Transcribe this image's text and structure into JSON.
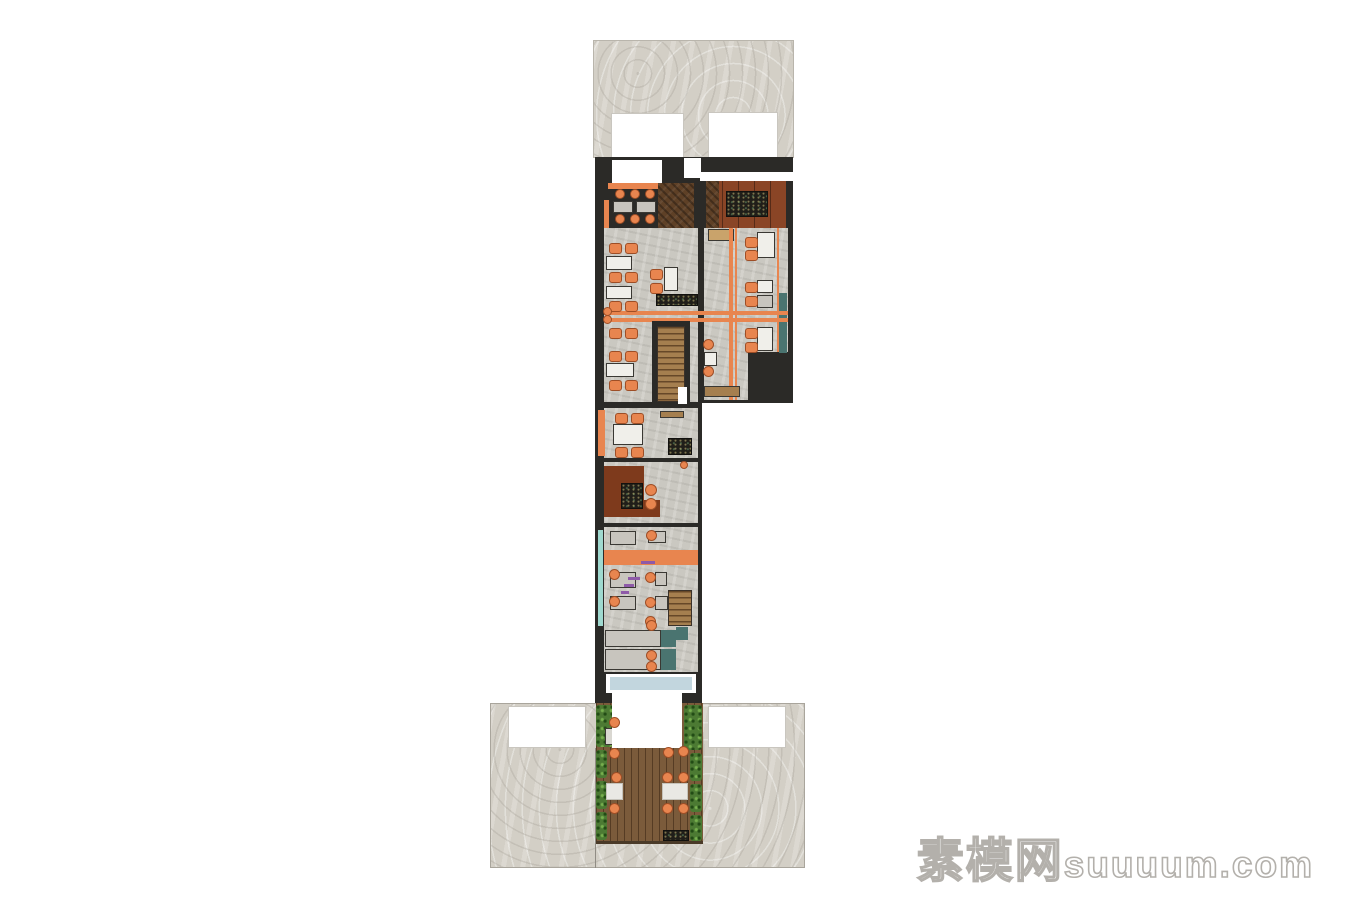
{
  "watermark": {
    "brand": "素模网",
    "site": "suuuum.com"
  },
  "palette": {
    "wall": "#2B2A27",
    "wallsoft": "#3A3833",
    "pave": "#D3CFC6",
    "conc": "#CAC8C1",
    "orange": "#E8854F",
    "orangeDark": "#9E4E26",
    "teal": "#4A7470",
    "tealLight": "#9FD9CF",
    "glass": "#C2D6DE",
    "white": "#FFFFFF",
    "rust": "#7E3A1C",
    "rust2": "#8A4526",
    "wood": "#A57F4F",
    "deckEdge": "#4A3A28",
    "tan": "#C9A36B",
    "grayTable": "#C8C5BE",
    "tableWhite": "#F0EFEA",
    "purple": "#8E5AA8",
    "hedge": "#4C7A33",
    "divider": "#908C84",
    "openingEdge": "#C9C6BF",
    "paveEdge": "#A9A59C"
  },
  "plan": {
    "items": [
      {
        "n": "upper-courtyard-pavement",
        "x": 593,
        "y": 40,
        "w": 201,
        "h": 118,
        "t": "tx-pave",
        "b": "#B9B5AC"
      },
      {
        "n": "upper-opening-left",
        "x": 611,
        "y": 113,
        "w": 73,
        "h": 50,
        "f": "white",
        "b": "openingEdge"
      },
      {
        "n": "upper-opening-right",
        "x": 708,
        "y": 112,
        "w": 70,
        "h": 50,
        "f": "white",
        "b": "openingEdge"
      },
      {
        "n": "wall-main-column",
        "x": 595,
        "y": 157,
        "w": 107,
        "h": 546,
        "f": "wall"
      },
      {
        "n": "wall-right-wing",
        "x": 702,
        "y": 157,
        "w": 91,
        "h": 246,
        "f": "wall"
      },
      {
        "n": "roomA-entry-white",
        "x": 612,
        "y": 160,
        "w": 50,
        "h": 25,
        "f": "white"
      },
      {
        "n": "roomA-wall-notch",
        "x": 684,
        "y": 158,
        "w": 17,
        "h": 20,
        "f": "white"
      },
      {
        "n": "roomA-wood-floor",
        "x": 658,
        "y": 183,
        "w": 36,
        "h": 47,
        "t": "tx-hb"
      },
      {
        "n": "roomA-bench-band",
        "x": 608,
        "y": 183,
        "w": 50,
        "h": 6,
        "f": "orange"
      },
      {
        "n": "roomA-table",
        "x": 613,
        "y": 201,
        "w": 20,
        "h": 12,
        "f": "grayTable",
        "b": "wallsoft"
      },
      {
        "n": "roomA-table",
        "x": 636,
        "y": 201,
        "w": 20,
        "h": 12,
        "f": "grayTable",
        "b": "wallsoft"
      },
      {
        "n": "roomA-side-bench",
        "x": 604,
        "y": 200,
        "w": 5,
        "h": 28,
        "f": "orange"
      },
      {
        "n": "roomB-beam-white",
        "x": 700,
        "y": 172,
        "w": 93,
        "h": 9,
        "f": "white"
      },
      {
        "n": "roomB-floor",
        "x": 706,
        "y": 181,
        "w": 80,
        "h": 50,
        "f": "rust2",
        "t": "tx-panel"
      },
      {
        "n": "roomB-wood-column",
        "x": 706,
        "y": 181,
        "w": 13,
        "h": 50,
        "t": "tx-hb"
      },
      {
        "n": "roomB-stone-table",
        "x": 726,
        "y": 191,
        "w": 42,
        "h": 26,
        "t": "tx-spk"
      },
      {
        "n": "roomC-floor",
        "x": 604,
        "y": 228,
        "w": 94,
        "h": 174,
        "t": "tx-conc"
      },
      {
        "n": "roomD-floor",
        "x": 704,
        "y": 228,
        "w": 84,
        "h": 172,
        "t": "tx-conc"
      },
      {
        "n": "roomD-dark-corner",
        "x": 748,
        "y": 352,
        "w": 40,
        "h": 48,
        "f": "wall"
      },
      {
        "n": "roomD-cabinet",
        "x": 708,
        "y": 229,
        "w": 26,
        "h": 12,
        "f": "tan",
        "b": "wallsoft"
      },
      {
        "n": "roomD-bench-stripe",
        "x": 729,
        "y": 228,
        "w": 4,
        "h": 172,
        "f": "orange"
      },
      {
        "n": "roomD-bench-stripe",
        "x": 735,
        "y": 228,
        "w": 2,
        "h": 172,
        "f": "orange"
      },
      {
        "n": "roomD-bench-stripe",
        "x": 777,
        "y": 228,
        "w": 2,
        "h": 124,
        "f": "orange"
      },
      {
        "n": "roomD-teal-panel",
        "x": 779,
        "y": 293,
        "w": 8,
        "h": 60,
        "f": "teal"
      },
      {
        "n": "roomD-table",
        "x": 757,
        "y": 232,
        "w": 18,
        "h": 26,
        "f": "tableWhite",
        "b": "wallsoft"
      },
      {
        "n": "roomD-table",
        "x": 757,
        "y": 280,
        "w": 16,
        "h": 13,
        "f": "tableWhite",
        "b": "wallsoft"
      },
      {
        "n": "roomD-table",
        "x": 757,
        "y": 295,
        "w": 16,
        "h": 13,
        "f": "grayTable",
        "b": "wallsoft"
      },
      {
        "n": "roomD-table",
        "x": 757,
        "y": 327,
        "w": 16,
        "h": 24,
        "f": "tableWhite",
        "b": "wallsoft"
      },
      {
        "n": "roomD-table",
        "x": 704,
        "y": 352,
        "w": 13,
        "h": 14,
        "f": "tableWhite",
        "b": "wallsoft"
      },
      {
        "n": "roomD-wood-bench",
        "x": 704,
        "y": 386,
        "w": 36,
        "h": 11,
        "f": "wood",
        "b": "wallsoft"
      },
      {
        "n": "dining-bench-stripe-h",
        "x": 604,
        "y": 311,
        "w": 184,
        "h": 4,
        "f": "orange"
      },
      {
        "n": "dining-bench-stripe-h",
        "x": 604,
        "y": 318,
        "w": 184,
        "h": 4,
        "f": "orange"
      },
      {
        "n": "roomC-table",
        "x": 606,
        "y": 256,
        "w": 26,
        "h": 14,
        "f": "tableWhite",
        "b": "wallsoft"
      },
      {
        "n": "roomC-table",
        "x": 606,
        "y": 286,
        "w": 26,
        "h": 13,
        "f": "tableWhite",
        "b": "wallsoft"
      },
      {
        "n": "roomC-table",
        "x": 664,
        "y": 267,
        "w": 14,
        "h": 24,
        "f": "tableWhite",
        "b": "wallsoft"
      },
      {
        "n": "roomC-table",
        "x": 606,
        "y": 363,
        "w": 28,
        "h": 14,
        "f": "tableWhite",
        "b": "wallsoft"
      },
      {
        "n": "roomC-counter",
        "x": 656,
        "y": 294,
        "w": 42,
        "h": 12,
        "t": "tx-spk"
      },
      {
        "n": "stair-main-surround",
        "x": 652,
        "y": 321,
        "w": 38,
        "h": 85,
        "f": "wall"
      },
      {
        "n": "stair-main-treads",
        "x": 657,
        "y": 326,
        "w": 28,
        "h": 76,
        "t": "tx-stair"
      },
      {
        "n": "stair-main-door",
        "x": 678,
        "y": 387,
        "w": 9,
        "h": 17,
        "f": "white"
      },
      {
        "n": "roomE-floor",
        "x": 604,
        "y": 408,
        "w": 94,
        "h": 50,
        "t": "tx-conc"
      },
      {
        "n": "roomE-bench-orange",
        "x": 598,
        "y": 410,
        "w": 7,
        "h": 46,
        "f": "orange"
      },
      {
        "n": "roomE-wood-shelf",
        "x": 660,
        "y": 411,
        "w": 24,
        "h": 7,
        "f": "wood",
        "b": "wallsoft"
      },
      {
        "n": "roomE-table",
        "x": 613,
        "y": 424,
        "w": 30,
        "h": 21,
        "f": "tableWhite",
        "b": "wallsoft"
      },
      {
        "n": "roomE-counter",
        "x": 668,
        "y": 438,
        "w": 24,
        "h": 17,
        "t": "tx-spk"
      },
      {
        "n": "kitchen-floor",
        "x": 604,
        "y": 462,
        "w": 94,
        "h": 61,
        "t": "tx-conc"
      },
      {
        "n": "kitchen-rust-floor",
        "x": 604,
        "y": 466,
        "w": 40,
        "h": 51,
        "f": "rust"
      },
      {
        "n": "kitchen-rust-floor",
        "x": 604,
        "y": 500,
        "w": 56,
        "h": 17,
        "f": "rust"
      },
      {
        "n": "kitchen-island",
        "x": 621,
        "y": 483,
        "w": 22,
        "h": 26,
        "t": "tx-spk"
      },
      {
        "n": "roomG-floor",
        "x": 604,
        "y": 527,
        "w": 94,
        "h": 145,
        "t": "tx-conc"
      },
      {
        "n": "roomG-teal-ledge",
        "x": 598,
        "y": 530,
        "w": 5,
        "h": 96,
        "f": "tealLight"
      },
      {
        "n": "roomG-table",
        "x": 610,
        "y": 531,
        "w": 26,
        "h": 14,
        "f": "grayTable",
        "b": "wallsoft"
      },
      {
        "n": "roomG-table",
        "x": 648,
        "y": 531,
        "w": 18,
        "h": 12,
        "f": "grayTable",
        "b": "wallsoft"
      },
      {
        "n": "roomG-table",
        "x": 610,
        "y": 572,
        "w": 26,
        "h": 16,
        "f": "grayTable",
        "b": "wallsoft"
      },
      {
        "n": "roomG-table",
        "x": 655,
        "y": 572,
        "w": 12,
        "h": 14,
        "f": "grayTable",
        "b": "wallsoft"
      },
      {
        "n": "roomG-table",
        "x": 610,
        "y": 596,
        "w": 26,
        "h": 14,
        "f": "grayTable",
        "b": "wallsoft"
      },
      {
        "n": "roomG-table",
        "x": 655,
        "y": 596,
        "w": 13,
        "h": 14,
        "f": "grayTable",
        "b": "wallsoft"
      },
      {
        "n": "roomG-service-band",
        "x": 604,
        "y": 550,
        "w": 94,
        "h": 15,
        "f": "orange"
      },
      {
        "n": "roomG-decor-mark",
        "x": 641,
        "y": 561,
        "w": 14,
        "h": 3,
        "f": "purple"
      },
      {
        "n": "roomG-decor-mark",
        "x": 628,
        "y": 577,
        "w": 12,
        "h": 3,
        "f": "purple"
      },
      {
        "n": "roomG-decor-mark",
        "x": 624,
        "y": 584,
        "w": 10,
        "h": 3,
        "f": "purple"
      },
      {
        "n": "roomG-decor-mark",
        "x": 621,
        "y": 591,
        "w": 8,
        "h": 3,
        "f": "purple"
      },
      {
        "n": "stair-rear-treads",
        "x": 668,
        "y": 590,
        "w": 24,
        "h": 36,
        "t": "tx-stair"
      },
      {
        "n": "roomG-teal-accent",
        "x": 676,
        "y": 627,
        "w": 12,
        "h": 13,
        "f": "teal"
      },
      {
        "n": "roomH-counter",
        "x": 605,
        "y": 630,
        "w": 56,
        "h": 17,
        "f": "grayTable",
        "b": "wallsoft"
      },
      {
        "n": "roomH-teal-top",
        "x": 661,
        "y": 630,
        "w": 15,
        "h": 17,
        "f": "teal"
      },
      {
        "n": "roomH-counter",
        "x": 605,
        "y": 649,
        "w": 56,
        "h": 21,
        "f": "grayTable",
        "b": "wallsoft"
      },
      {
        "n": "roomH-teal-top",
        "x": 661,
        "y": 649,
        "w": 15,
        "h": 21,
        "f": "teal"
      },
      {
        "n": "entrance-frame",
        "x": 606,
        "y": 674,
        "w": 90,
        "h": 19,
        "f": "white"
      },
      {
        "n": "entrance-glass",
        "x": 610,
        "y": 677,
        "w": 82,
        "h": 13,
        "f": "glass"
      },
      {
        "n": "lower-courtyard-pavement",
        "x": 490,
        "y": 703,
        "w": 315,
        "h": 165,
        "t": "tx-pave",
        "b": "paveEdge"
      },
      {
        "n": "lower-opening-left",
        "x": 508,
        "y": 706,
        "w": 78,
        "h": 42,
        "f": "white",
        "b": "openingEdge"
      },
      {
        "n": "lower-opening-right",
        "x": 708,
        "y": 706,
        "w": 78,
        "h": 42,
        "f": "white",
        "b": "openingEdge"
      },
      {
        "n": "courtyard-divider-line",
        "x": 595,
        "y": 748,
        "w": 1,
        "h": 120,
        "f": "divider"
      },
      {
        "n": "terrace-deck",
        "x": 596,
        "y": 703,
        "w": 107,
        "h": 140,
        "t": "tx-deck"
      },
      {
        "n": "terrace-deck-edge",
        "x": 596,
        "y": 841,
        "w": 107,
        "h": 3,
        "f": "deckEdge"
      },
      {
        "n": "terrace-grill",
        "x": 663,
        "y": 830,
        "w": 26,
        "h": 11,
        "t": "tx-spk"
      },
      {
        "n": "terrace-hedge",
        "x": 596,
        "y": 705,
        "w": 17,
        "h": 42,
        "t": "tx-hedge"
      },
      {
        "n": "terrace-hedge",
        "x": 596,
        "y": 750,
        "w": 11,
        "h": 28,
        "t": "tx-hedge"
      },
      {
        "n": "terrace-hedge",
        "x": 596,
        "y": 781,
        "w": 11,
        "h": 28,
        "t": "tx-hedge"
      },
      {
        "n": "terrace-hedge",
        "x": 596,
        "y": 812,
        "w": 11,
        "h": 28,
        "t": "tx-hedge"
      },
      {
        "n": "terrace-hedge",
        "x": 684,
        "y": 705,
        "w": 18,
        "h": 45,
        "t": "tx-hedge"
      },
      {
        "n": "terrace-hedge",
        "x": 690,
        "y": 753,
        "w": 12,
        "h": 28,
        "t": "tx-hedge"
      },
      {
        "n": "terrace-hedge",
        "x": 690,
        "y": 784,
        "w": 12,
        "h": 28,
        "t": "tx-hedge"
      },
      {
        "n": "terrace-hedge",
        "x": 690,
        "y": 815,
        "w": 12,
        "h": 26,
        "t": "tx-hedge"
      },
      {
        "n": "terrace-table",
        "x": 605,
        "y": 728,
        "w": 16,
        "h": 17,
        "f": "#D9D7D1",
        "b": "wallsoft"
      },
      {
        "n": "terrace-table",
        "x": 606,
        "y": 783,
        "w": 17,
        "h": 17,
        "f": "#E9E8E4",
        "b": "#C5C2BA"
      },
      {
        "n": "terrace-table",
        "x": 662,
        "y": 783,
        "w": 26,
        "h": 17,
        "f": "#E9E8E4",
        "b": "#C5C2BA"
      },
      {
        "n": "vestibule-canopy",
        "x": 612,
        "y": 692,
        "w": 70,
        "h": 56,
        "f": "white"
      }
    ],
    "chairs": [
      {
        "n": "roomC-chair",
        "x": 609,
        "y": 243
      },
      {
        "n": "roomC-chair",
        "x": 625,
        "y": 243
      },
      {
        "n": "roomC-chair",
        "x": 609,
        "y": 272
      },
      {
        "n": "roomC-chair",
        "x": 625,
        "y": 272
      },
      {
        "n": "roomC-chair",
        "x": 609,
        "y": 301
      },
      {
        "n": "roomC-chair",
        "x": 625,
        "y": 301
      },
      {
        "n": "roomC-chair",
        "x": 650,
        "y": 269
      },
      {
        "n": "roomC-chair",
        "x": 650,
        "y": 283
      },
      {
        "n": "roomC-chair",
        "x": 609,
        "y": 328
      },
      {
        "n": "roomC-chair",
        "x": 625,
        "y": 328
      },
      {
        "n": "roomC-chair",
        "x": 609,
        "y": 351
      },
      {
        "n": "roomC-chair",
        "x": 625,
        "y": 351
      },
      {
        "n": "roomC-chair",
        "x": 609,
        "y": 380
      },
      {
        "n": "roomC-chair",
        "x": 625,
        "y": 380
      },
      {
        "n": "roomD-chair",
        "x": 745,
        "y": 237
      },
      {
        "n": "roomD-chair",
        "x": 745,
        "y": 250
      },
      {
        "n": "roomD-chair",
        "x": 745,
        "y": 282
      },
      {
        "n": "roomD-chair",
        "x": 745,
        "y": 296
      },
      {
        "n": "roomD-chair",
        "x": 745,
        "y": 328
      },
      {
        "n": "roomD-chair",
        "x": 745,
        "y": 342
      },
      {
        "n": "roomE-chair",
        "x": 615,
        "y": 413
      },
      {
        "n": "roomE-chair",
        "x": 631,
        "y": 413
      },
      {
        "n": "roomE-chair",
        "x": 615,
        "y": 447
      },
      {
        "n": "roomE-chair",
        "x": 631,
        "y": 447
      }
    ],
    "stools": [
      {
        "n": "roomA-stool",
        "x": 615,
        "y": 189,
        "d": 10
      },
      {
        "n": "roomA-stool",
        "x": 630,
        "y": 189,
        "d": 10
      },
      {
        "n": "roomA-stool",
        "x": 645,
        "y": 189,
        "d": 10
      },
      {
        "n": "roomA-stool",
        "x": 615,
        "y": 214,
        "d": 10
      },
      {
        "n": "roomA-stool",
        "x": 630,
        "y": 214,
        "d": 10
      },
      {
        "n": "roomA-stool",
        "x": 645,
        "y": 214,
        "d": 10
      },
      {
        "n": "roomC-bench-stool",
        "x": 603,
        "y": 307,
        "d": 9
      },
      {
        "n": "roomC-bench-stool",
        "x": 603,
        "y": 315,
        "d": 9
      },
      {
        "n": "roomD-stool",
        "x": 703,
        "y": 339,
        "d": 11
      },
      {
        "n": "roomD-stool",
        "x": 703,
        "y": 366,
        "d": 11
      },
      {
        "n": "kitchen-burner",
        "x": 645,
        "y": 484,
        "d": 12
      },
      {
        "n": "kitchen-burner",
        "x": 645,
        "y": 498,
        "d": 12
      },
      {
        "n": "kitchen-stool",
        "x": 680,
        "y": 461,
        "d": 8
      },
      {
        "n": "roomG-stool",
        "x": 646,
        "y": 530,
        "d": 11
      },
      {
        "n": "roomG-stool",
        "x": 609,
        "y": 569,
        "d": 11
      },
      {
        "n": "roomG-stool",
        "x": 645,
        "y": 572,
        "d": 11
      },
      {
        "n": "roomG-stool",
        "x": 609,
        "y": 596,
        "d": 11
      },
      {
        "n": "roomG-stool",
        "x": 645,
        "y": 597,
        "d": 11
      },
      {
        "n": "roomG-stool",
        "x": 645,
        "y": 616,
        "d": 11
      },
      {
        "n": "roomH-stool",
        "x": 646,
        "y": 620,
        "d": 11
      },
      {
        "n": "roomH-stool",
        "x": 646,
        "y": 650,
        "d": 11
      },
      {
        "n": "roomH-stool",
        "x": 646,
        "y": 661,
        "d": 11
      },
      {
        "n": "terrace-stool",
        "x": 609,
        "y": 717,
        "d": 11
      },
      {
        "n": "terrace-stool",
        "x": 609,
        "y": 748,
        "d": 11
      },
      {
        "n": "terrace-stool",
        "x": 611,
        "y": 772,
        "d": 11
      },
      {
        "n": "terrace-stool",
        "x": 609,
        "y": 803,
        "d": 11
      },
      {
        "n": "terrace-stool",
        "x": 663,
        "y": 747,
        "d": 11
      },
      {
        "n": "terrace-stool",
        "x": 678,
        "y": 746,
        "d": 11
      },
      {
        "n": "terrace-stool",
        "x": 662,
        "y": 772,
        "d": 11
      },
      {
        "n": "terrace-stool",
        "x": 678,
        "y": 772,
        "d": 11
      },
      {
        "n": "terrace-stool",
        "x": 662,
        "y": 803,
        "d": 11
      },
      {
        "n": "terrace-stool",
        "x": 678,
        "y": 803,
        "d": 11
      }
    ]
  }
}
